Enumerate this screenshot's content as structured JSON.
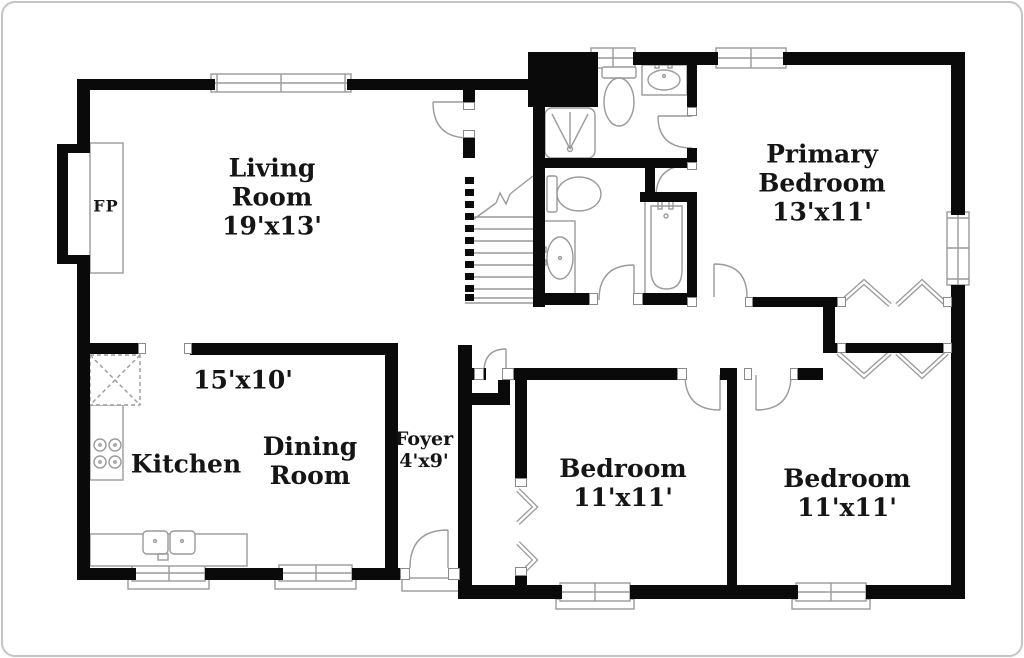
{
  "floorplan": {
    "colors": {
      "wall": "#0a0a0a",
      "fixture": "#9a9a9a",
      "text": "#151515",
      "background": "#ffffff",
      "frame": "#c4c4c4"
    },
    "rooms": {
      "living_room": {
        "line1": "Living",
        "line2": "Room",
        "dims": "19'x13'"
      },
      "dining_room": {
        "line1": "Dining",
        "line2": "Room",
        "dims": "15'x10'"
      },
      "kitchen": {
        "name": "Kitchen"
      },
      "foyer": {
        "name": "Foyer",
        "dims": "4'x9'"
      },
      "primary_bedroom": {
        "line1": "Primary",
        "line2": "Bedroom",
        "dims": "13'x11'"
      },
      "bedroom_left": {
        "name": "Bedroom",
        "dims": "11'x11'"
      },
      "bedroom_right": {
        "name": "Bedroom",
        "dims": "11'x11'"
      },
      "fireplace": {
        "abbr": "FP"
      }
    }
  }
}
